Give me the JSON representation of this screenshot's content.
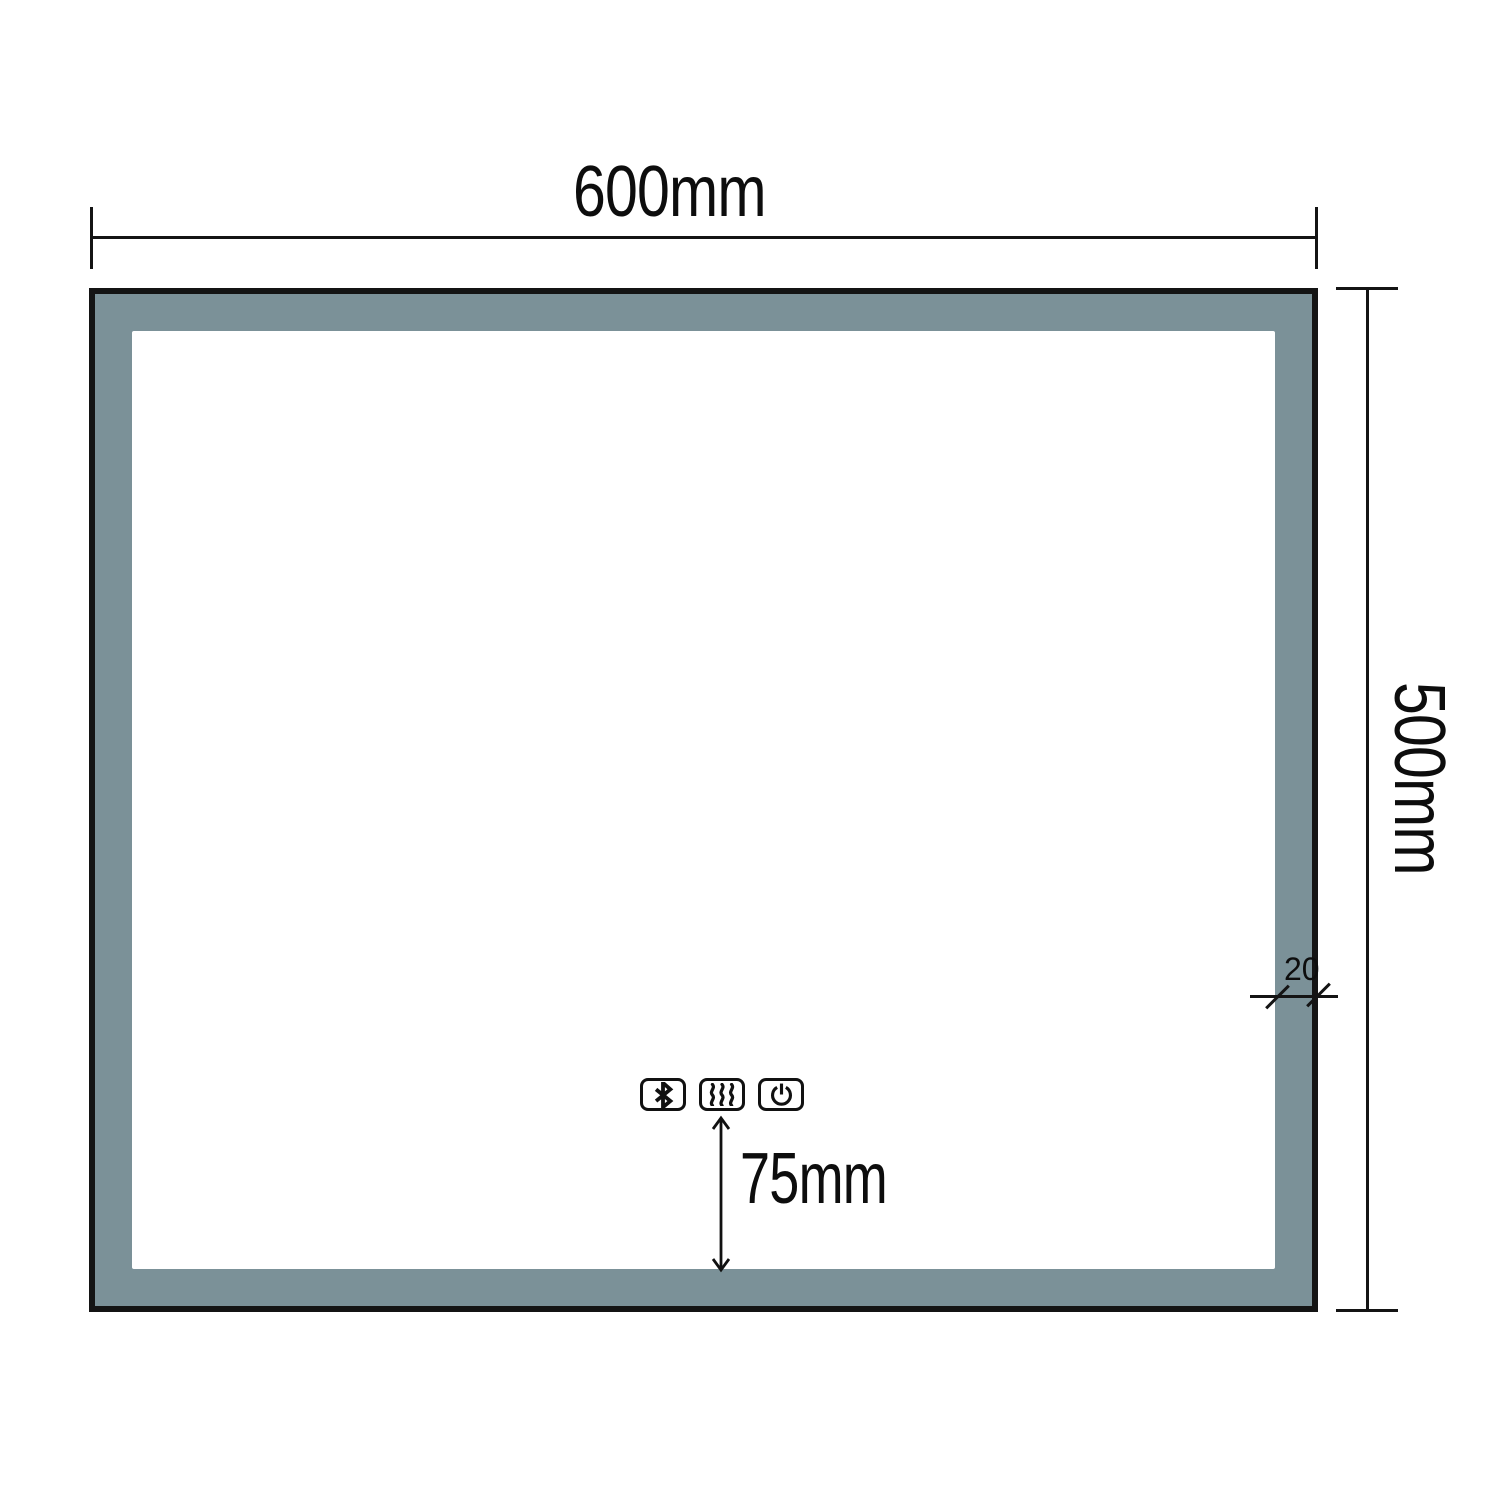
{
  "diagram": {
    "type": "technical-drawing",
    "subject": "LED mirror front view with dimensions",
    "dimensions": {
      "width": {
        "label": "600mm"
      },
      "height": {
        "label": "500mm"
      },
      "frame_thickness": {
        "label": "20"
      },
      "controls_offset": {
        "label": "75mm"
      }
    },
    "controls": {
      "buttons": [
        {
          "name": "bluetooth-button",
          "icon": "bluetooth-icon"
        },
        {
          "name": "defog-button",
          "icon": "defog-icon"
        },
        {
          "name": "power-button",
          "icon": "power-icon"
        }
      ]
    },
    "colors": {
      "frame_fill": "#7b9198",
      "outline": "#141414",
      "background": "#ffffff"
    }
  }
}
